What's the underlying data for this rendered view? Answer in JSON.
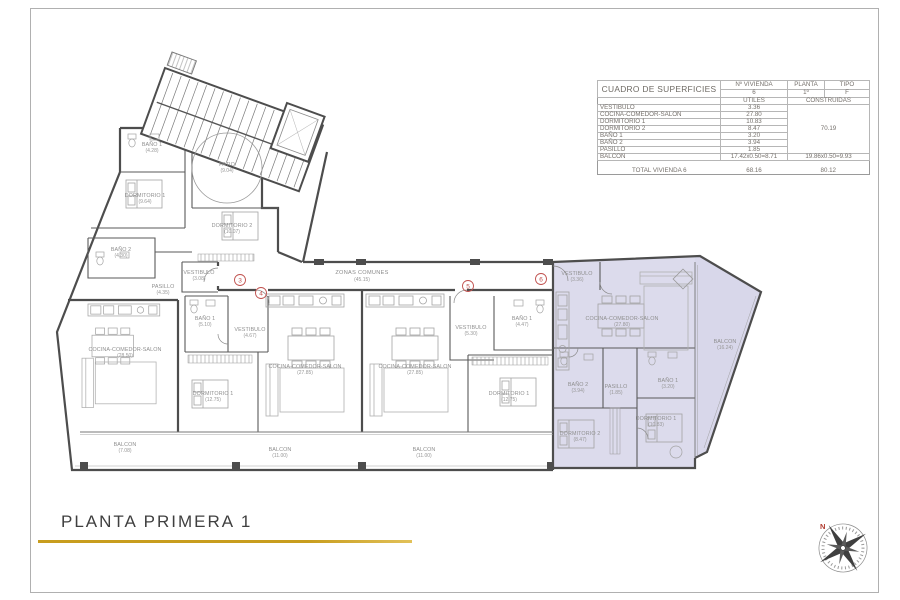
{
  "page": {
    "title": "PLANTA PRIMERA 1"
  },
  "areas_table": {
    "title": "CUADRO DE SUPERFICIES",
    "col_vivienda_label": "Nº VIVIENDA",
    "col_planta_label": "PLANTA",
    "col_tipo_label": "TIPO",
    "vivienda_value": "6",
    "planta_value": "1º",
    "tipo_value": "F",
    "col_utiles": "UTILES",
    "col_construidas": "CONSTRUIDAS",
    "rows": [
      {
        "name": "VESTIBULO",
        "utiles": "3.36"
      },
      {
        "name": "COCINA-COMEDOR-SALON",
        "utiles": "27.80"
      },
      {
        "name": "DORMITORIO 1",
        "utiles": "10.83"
      },
      {
        "name": "DORMITORIO 2",
        "utiles": "8.47"
      },
      {
        "name": "BAÑO 1",
        "utiles": "3.20"
      },
      {
        "name": "BAÑO 2",
        "utiles": "3.94"
      },
      {
        "name": "PASILLO",
        "utiles": "1.85"
      },
      {
        "name": "BALCON",
        "utiles": "17.42x0.50=8.71",
        "construidas": "19.86x0.50=9.93"
      }
    ],
    "construidas_value": "70.19",
    "total_label": "TOTAL VIVIENDA 6",
    "total_utiles": "68.16",
    "total_construidas": "80.12"
  },
  "plan": {
    "zonas_comunes": {
      "name": "ZONAS COMUNES",
      "area": "(45.15)"
    },
    "units": [
      "3",
      "4",
      "5",
      "6"
    ],
    "labels": [
      {
        "name": "BAÑO 1",
        "area": "(4.28)"
      },
      {
        "name": "DORMITORIO 1",
        "area": "(9.64)"
      },
      {
        "name": "PATIO",
        "area": "(9.04)"
      },
      {
        "name": "DORMITORIO 2",
        "area": "(10.07)"
      },
      {
        "name": "BAÑO 2",
        "area": "(4.30)"
      },
      {
        "name": "VESTIBULO",
        "area": "(3.08)"
      },
      {
        "name": "PASILLO",
        "area": "(4.35)"
      },
      {
        "name": "COCINA-COMEDOR-SALON",
        "area": "(28.50)"
      },
      {
        "name": "BALCON",
        "area": "(7.08)"
      },
      {
        "name": "BAÑO 1",
        "area": "(5.10)"
      },
      {
        "name": "VESTIBULO",
        "area": "(4.67)"
      },
      {
        "name": "DORMITORIO 1",
        "area": "(12.75)"
      },
      {
        "name": "COCINA-COMEDOR-SALON",
        "area": "(27.85)"
      },
      {
        "name": "BALCON",
        "area": "(11.00)"
      },
      {
        "name": "VESTIBULO",
        "area": "(5.30)"
      },
      {
        "name": "BAÑO 1",
        "area": "(4.47)"
      },
      {
        "name": "COCINA-COMEDOR-SALON",
        "area": "(27.85)"
      },
      {
        "name": "DORMITORIO 1",
        "area": "(12.75)"
      },
      {
        "name": "BALCON",
        "area": "(11.00)"
      },
      {
        "name": "VESTIBULO",
        "area": "(3.36)"
      },
      {
        "name": "COCINA-COMEDOR-SALON",
        "area": "(27.80)"
      },
      {
        "name": "BALCON",
        "area": "(16.24)"
      },
      {
        "name": "BAÑO 2",
        "area": "(3.94)"
      },
      {
        "name": "PASILLO",
        "area": "(1.85)"
      },
      {
        "name": "BAÑO 1",
        "area": "(3.20)"
      },
      {
        "name": "DORMITORIO 2",
        "area": "(8.47)"
      },
      {
        "name": "DORMITORIO 1",
        "area": "(10.83)"
      }
    ]
  },
  "compass": {
    "north": "N"
  }
}
